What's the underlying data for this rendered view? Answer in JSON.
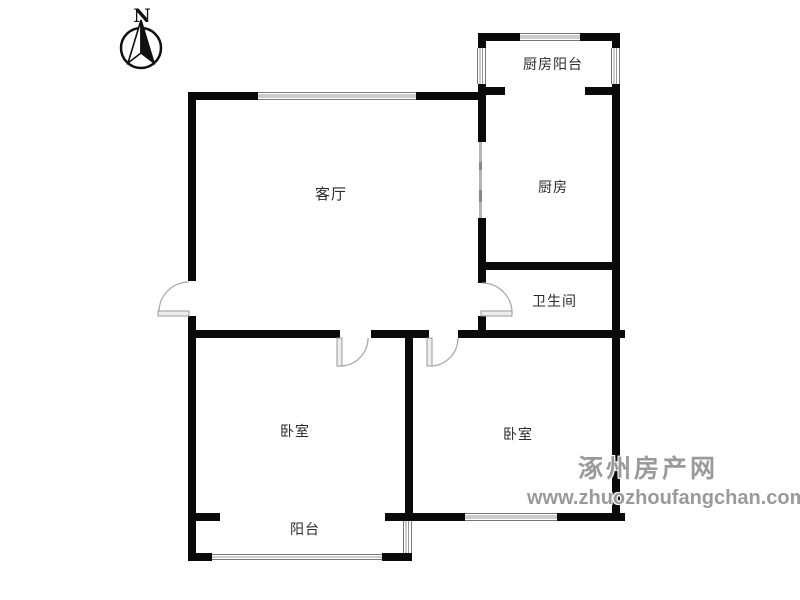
{
  "compass": {
    "label": "N"
  },
  "rooms": {
    "living": {
      "label": "客厅"
    },
    "kitchen_balcony": {
      "label": "厨房阳台"
    },
    "kitchen": {
      "label": "厨房"
    },
    "bathroom": {
      "label": "卫生间"
    },
    "bedroom_left": {
      "label": "卧室"
    },
    "bedroom_right": {
      "label": "卧室"
    },
    "balcony": {
      "label": "阳台"
    }
  },
  "watermark": {
    "site_name": "涿州房产网",
    "site_url": "www.zhuozhoufangchan.com"
  },
  "colors": {
    "background": "#ffffff",
    "wall": "#0a0a0a",
    "window_frame": "#777777",
    "window_pane": "#9a9a9a",
    "door_arc": "#aaaaaa",
    "door_leaf_fill": "#ededed",
    "label_text": "#2b2b2b",
    "watermark_text": "#9a9a9a"
  }
}
